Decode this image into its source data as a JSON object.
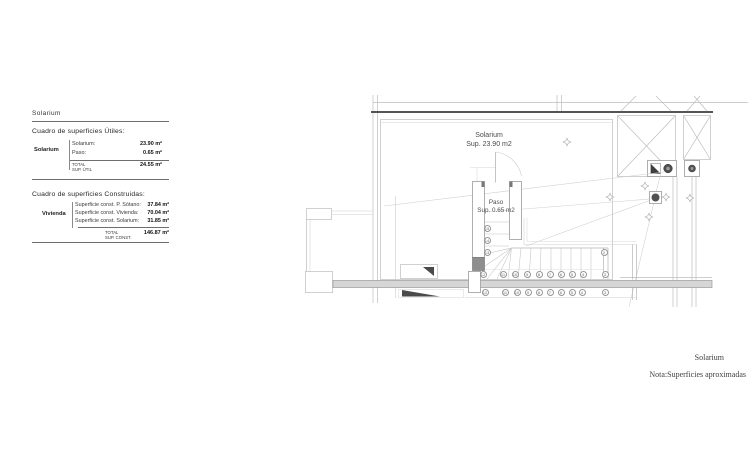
{
  "left_panel": {
    "title": "Solarium",
    "utiles": {
      "heading": "Cuadro de superficies Útiles:",
      "group": "Solarium",
      "rows": [
        {
          "label": "Solarium:",
          "value": "23.90 m²"
        },
        {
          "label": "Paso:",
          "value": "0.65 m²"
        }
      ],
      "total": {
        "label1": "TOTAL",
        "label2": "SUP. ÚTIL",
        "value": "24.55 m²"
      }
    },
    "construidas": {
      "heading": "Cuadro de superficies Construidas:",
      "group": "Vivienda",
      "rows": [
        {
          "label": "Superficie const. P. Sótano:",
          "value": "37.84 m²"
        },
        {
          "label": "Superficie const. Vivienda:",
          "value": "70.04 m²"
        },
        {
          "label": "Superficie const. Solarium:",
          "value": "31.85 m²"
        }
      ],
      "total": {
        "label1": "TOTAL",
        "label2": "SUP. CONST.",
        "value": "146.87 m²"
      }
    }
  },
  "plan": {
    "solarium_room": {
      "name": "Solarium",
      "area": "Sup. 23.90 m2"
    },
    "paso_room": {
      "name": "Paso",
      "area": "Sup. 0.65 m2"
    },
    "stair_circles": [
      {
        "x": 487,
        "y": 228,
        "n": "15"
      },
      {
        "x": 487,
        "y": 240,
        "n": "14"
      },
      {
        "x": 487,
        "y": 252,
        "n": "13"
      },
      {
        "x": 604,
        "y": 252,
        "n": "2"
      },
      {
        "x": 483,
        "y": 274.5,
        "n": "12"
      },
      {
        "x": 503,
        "y": 274.5,
        "n": "11"
      },
      {
        "x": 515,
        "y": 274.5,
        "n": "10"
      },
      {
        "x": 527,
        "y": 274.5,
        "n": "9"
      },
      {
        "x": 539,
        "y": 274.5,
        "n": "8"
      },
      {
        "x": 550,
        "y": 274.5,
        "n": "7"
      },
      {
        "x": 561,
        "y": 274.5,
        "n": "6"
      },
      {
        "x": 572,
        "y": 274.5,
        "n": "5"
      },
      {
        "x": 583,
        "y": 274.5,
        "n": "4"
      },
      {
        "x": 605,
        "y": 274.5,
        "n": "3"
      },
      {
        "x": 485,
        "y": 292.5,
        "n": "12"
      },
      {
        "x": 505,
        "y": 292.5,
        "n": "11"
      },
      {
        "x": 517,
        "y": 292.5,
        "n": "10"
      },
      {
        "x": 528,
        "y": 292.5,
        "n": "9"
      },
      {
        "x": 539,
        "y": 292.5,
        "n": "8"
      },
      {
        "x": 550,
        "y": 292.5,
        "n": "7"
      },
      {
        "x": 561,
        "y": 292.5,
        "n": "6"
      },
      {
        "x": 572,
        "y": 292.5,
        "n": "5"
      },
      {
        "x": 582,
        "y": 292.5,
        "n": "4"
      },
      {
        "x": 605,
        "y": 292.5,
        "n": "3"
      }
    ],
    "slope_arrows": [
      {
        "x": 567,
        "y": 142
      },
      {
        "x": 610,
        "y": 197
      },
      {
        "x": 645,
        "y": 186
      },
      {
        "x": 666,
        "y": 197
      },
      {
        "x": 690,
        "y": 198
      },
      {
        "x": 649,
        "y": 217
      }
    ],
    "symbols": {
      "drain": "drain-square-icon",
      "slope_arrow": "slope-arrow-icon",
      "shaft": "crossed-shaft-box",
      "light": "ceiling-light-icon"
    },
    "colors": {
      "line_light": "#bdbdbd",
      "line_dark": "#3d3d3d",
      "section_band": "#d6d6d6",
      "symbol_fill": "#4a4a4a"
    }
  },
  "footer": {
    "sheet_title": "Solarium",
    "note": "Nota:Superficies aproximadas"
  }
}
